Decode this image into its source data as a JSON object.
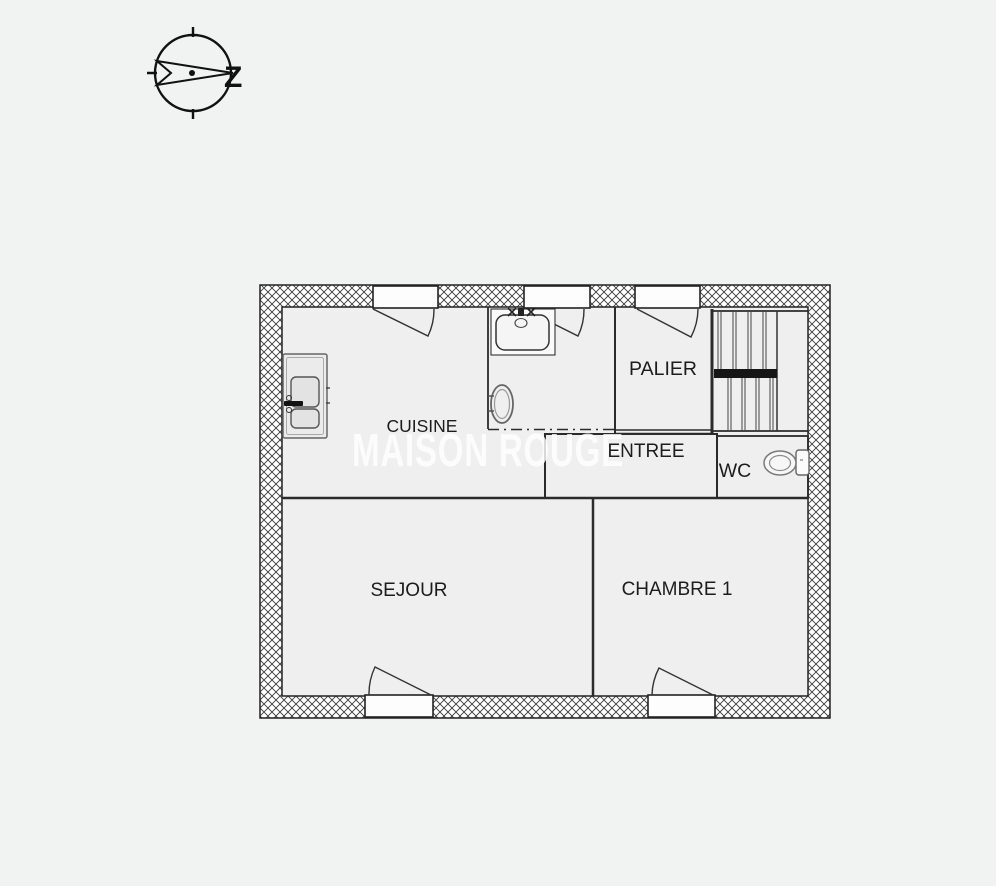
{
  "compass": {
    "label": "Z"
  },
  "watermark": {
    "text": "MAISON ROUGE",
    "color": "rgba(255,255,255,0.82)"
  },
  "rooms": {
    "cuisine": {
      "label": "CUISINE"
    },
    "palier": {
      "label": "PALIER"
    },
    "entree": {
      "label": "ENTREE"
    },
    "wc": {
      "label": "WC"
    },
    "sejour": {
      "label": "SEJOUR"
    },
    "chambre1": {
      "label": "CHAMBRE 1"
    }
  },
  "fixtures": {
    "stairs": "stairs",
    "sink": "kitchen-sink",
    "toilet": "toilet",
    "appliance": "kitchen-appliance",
    "oval_basin": "oval-basin",
    "windows": "casement-windows"
  },
  "colors": {
    "background": "#f1f2f2",
    "room_fill": "#efefef",
    "line": "#2b2b2b",
    "stair_band": "#161616"
  }
}
